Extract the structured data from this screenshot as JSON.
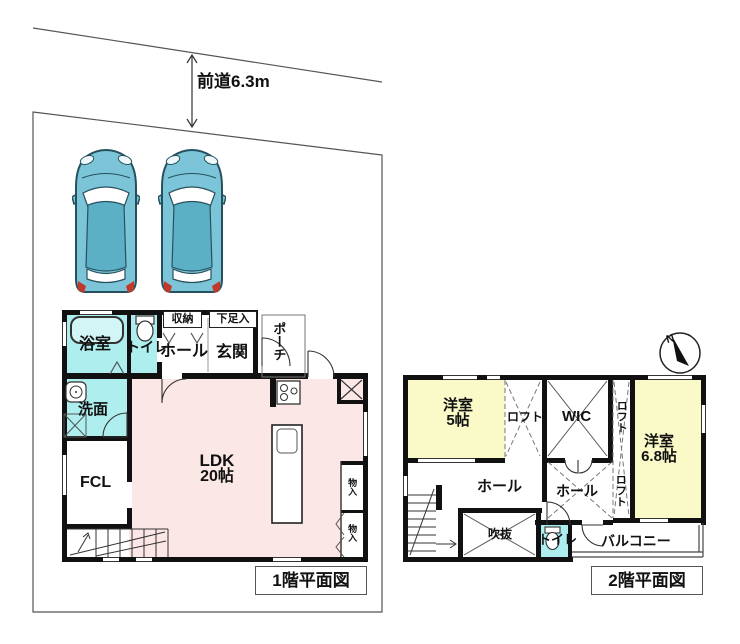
{
  "site": {
    "road_label": "前道6.3m",
    "north_label": "N"
  },
  "floor1": {
    "title": "1階平面図",
    "bath": "浴室",
    "toilet": "トイレ",
    "storage": "収納",
    "shoe_cabinet": "下足入",
    "hall": "ホール",
    "entrance": "玄関",
    "porch": "ポーチ",
    "washroom": "洗面",
    "fcl": "FCL",
    "ldk_name": "LDK",
    "ldk_size": "20帖",
    "closet_upper": "物入",
    "closet_lower": "物入"
  },
  "floor2": {
    "title": "2階平面図",
    "room5_name": "洋室",
    "room5_size": "5帖",
    "loft_left": "ロフト",
    "wic": "WIC",
    "loft_mid": "ロフト",
    "loft_lower": "ロフト",
    "room68_name": "洋室",
    "room68_size": "6.8帖",
    "hall_left": "ホール",
    "hall_center": "ホール",
    "void": "吹抜",
    "toilet": "トイレ",
    "balcony": "バルコニー"
  },
  "colors": {
    "room_teal": "#aeeeee",
    "tub": "#d2f6f6",
    "ldk_pink": "#fbe7e5",
    "room_yellow": "#fafac8",
    "car_body": "#7cc5d8",
    "car_roof": "#5cb0c6",
    "wall": "#111111"
  }
}
